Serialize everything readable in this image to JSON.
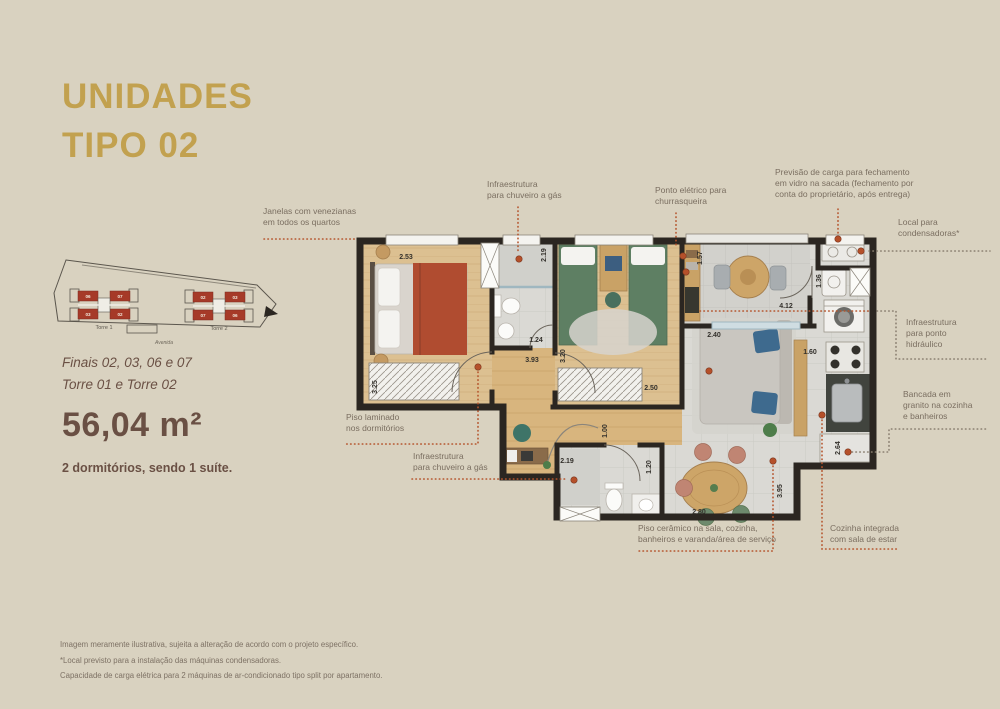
{
  "title": {
    "line1": "UNIDADES",
    "line2": "TIPO 02"
  },
  "site_plan": {
    "torre1": {
      "label": "Torre 1",
      "units": [
        "06",
        "07",
        "03",
        "02"
      ]
    },
    "torre2": {
      "label": "Torre 2",
      "units": [
        "02",
        "03",
        "07",
        "06"
      ]
    },
    "street": "Avenida"
  },
  "details": {
    "finais": "Finais 02, 03, 06 e 07",
    "torres": "Torre 01 e Torre 02",
    "area": "56,04 m²",
    "dorms": "2 dormitórios, sendo 1 suíte."
  },
  "annotations": [
    {
      "id": "janelas",
      "text": "Janelas com venezianas\nem todos os quartos",
      "left": 263,
      "top": 206,
      "width": 120,
      "leader": {
        "color": "orange",
        "lines": [
          [
            [
              264,
              239
            ],
            [
              357,
              239
            ]
          ]
        ]
      }
    },
    {
      "id": "chuveiro-topo",
      "text": "Infraestrutura\npara chuveiro a gás",
      "left": 487,
      "top": 179,
      "width": 110,
      "leader": {
        "color": "orange",
        "lines": [
          [
            [
              518,
              207
            ],
            [
              518,
              253
            ]
          ]
        ],
        "dot": [
          519,
          259
        ]
      }
    },
    {
      "id": "ponto-churrasqueira",
      "text": "Ponto elétrico para\nchurrasqueira",
      "left": 655,
      "top": 185,
      "width": 110,
      "leader": {
        "color": "orange",
        "lines": [
          [
            [
              676,
              213
            ],
            [
              676,
              248
            ]
          ]
        ],
        "dot": [
          683,
          256
        ]
      }
    },
    {
      "id": "previsao-carga",
      "text": "Previsão de carga para fechamento\nem vidro na sacada (fechamento por\nconta do proprietário, após entrega)",
      "left": 775,
      "top": 167,
      "width": 175,
      "leader": {
        "color": "orange",
        "lines": [
          [
            [
              838,
              209
            ],
            [
              838,
              233
            ]
          ]
        ],
        "dot": [
          838,
          239
        ]
      }
    },
    {
      "id": "local-condensadoras",
      "text": "Local para\ncondensadoras*",
      "left": 898,
      "top": 217,
      "width": 95,
      "leader": {
        "color": "gray",
        "lines": [
          [
            [
              869,
              251
            ],
            [
              990,
              251
            ]
          ]
        ],
        "dot": [
          861,
          251
        ]
      }
    },
    {
      "id": "ponto-hidraulico",
      "text": "Infraestrutura\npara ponto\nhidráulico",
      "left": 906,
      "top": 317,
      "width": 80,
      "leader": {
        "color": "gray",
        "lines": [
          [
            [
              877,
              311
            ],
            [
              896,
              311
            ],
            [
              896,
              359
            ],
            [
              988,
              359
            ]
          ]
        ]
      }
    },
    {
      "id": "bancada-granito",
      "text": "Bancada em\ngranito na cozinha\ne banheiros",
      "left": 903,
      "top": 389,
      "width": 90,
      "leader": {
        "color": "gray",
        "lines": [
          [
            [
              852,
              452
            ],
            [
              889,
              452
            ],
            [
              889,
              429
            ],
            [
              988,
              429
            ]
          ]
        ],
        "dot": [
          848,
          452
        ]
      }
    },
    {
      "id": "cozinha-integrada",
      "text": "Cozinha integrada\ncom sala de estar",
      "left": 830,
      "top": 523,
      "width": 95,
      "leader": {
        "color": "orange",
        "lines": [
          [
            [
              822,
              420
            ],
            [
              822,
              549
            ],
            [
              897,
              549
            ]
          ]
        ],
        "dot": [
          822,
          415
        ]
      }
    },
    {
      "id": "piso-ceramico",
      "text": "Piso cerâmico na sala, cozinha,\nbanheiros e varanda/área de serviço",
      "left": 638,
      "top": 523,
      "width": 155,
      "leader": {
        "color": "orange",
        "lines": [
          [
            [
              773,
              466
            ],
            [
              773,
              551
            ],
            [
              637,
              551
            ]
          ]
        ],
        "dot": [
          773,
          461
        ]
      }
    },
    {
      "id": "chuveiro-baixo",
      "text": "Infraestrutura\npara chuveiro a gás",
      "left": 413,
      "top": 451,
      "width": 110,
      "leader": {
        "color": "orange",
        "lines": [
          [
            [
              412,
              479
            ],
            [
              568,
              479
            ]
          ]
        ],
        "dot": [
          574,
          480
        ]
      }
    },
    {
      "id": "piso-laminado",
      "text": "Piso laminado\nnos dormitórios",
      "left": 346,
      "top": 412,
      "width": 100,
      "leader": {
        "color": "orange",
        "lines": [
          [
            [
              478,
              372
            ],
            [
              478,
              444
            ],
            [
              344,
              444
            ]
          ]
        ],
        "dot": [
          478,
          367
        ]
      }
    }
  ],
  "measure_lines": [
    [
      [
        700,
        311
      ],
      [
        871,
        311
      ]
    ]
  ],
  "extra_dots": [
    [
      709,
      371
    ],
    [
      686,
      272
    ]
  ],
  "dimensions": [
    {
      "t": "2.53",
      "x": 406,
      "y": 259
    },
    {
      "t": "3.25",
      "x": 377,
      "y": 387,
      "v": true
    },
    {
      "t": "2.19",
      "x": 546,
      "y": 255,
      "v": true
    },
    {
      "t": "1.24",
      "x": 536,
      "y": 342
    },
    {
      "t": "3.93",
      "x": 532,
      "y": 362
    },
    {
      "t": "3.20",
      "x": 565,
      "y": 356,
      "v": true
    },
    {
      "t": "2.50",
      "x": 651,
      "y": 390
    },
    {
      "t": "1.57",
      "x": 702,
      "y": 258,
      "v": true
    },
    {
      "t": "1.36",
      "x": 821,
      "y": 281,
      "v": true
    },
    {
      "t": "4.12",
      "x": 786,
      "y": 308
    },
    {
      "t": "2.40",
      "x": 714,
      "y": 337
    },
    {
      "t": "1.60",
      "x": 810,
      "y": 354
    },
    {
      "t": "1.00",
      "x": 607,
      "y": 431,
      "v": true
    },
    {
      "t": "2.19",
      "x": 567,
      "y": 463
    },
    {
      "t": "1.20",
      "x": 651,
      "y": 467,
      "v": true
    },
    {
      "t": "2.80",
      "x": 699,
      "y": 514
    },
    {
      "t": "3.95",
      "x": 782,
      "y": 491,
      "v": true
    },
    {
      "t": "2.64",
      "x": 840,
      "y": 448,
      "v": true
    }
  ],
  "footer": [
    "Imagem meramente ilustrativa, sujeita a alteração de acordo com o projeto específico.",
    "*Local previsto para a instalação das máquinas condensadoras.",
    "Capacidade de carga elétrica para 2 máquinas de ar-condicionado tipo split por apartamento."
  ],
  "colors": {
    "background": "#d9d2c0",
    "accent_gold": "#c2a14f",
    "text_brown": "#6a5044",
    "text_gray": "#7a6e60",
    "leader_orange": "#b5542c",
    "leader_gray": "#8a7f70",
    "wall": "#2b2621",
    "unit_red": "#a63a28"
  }
}
